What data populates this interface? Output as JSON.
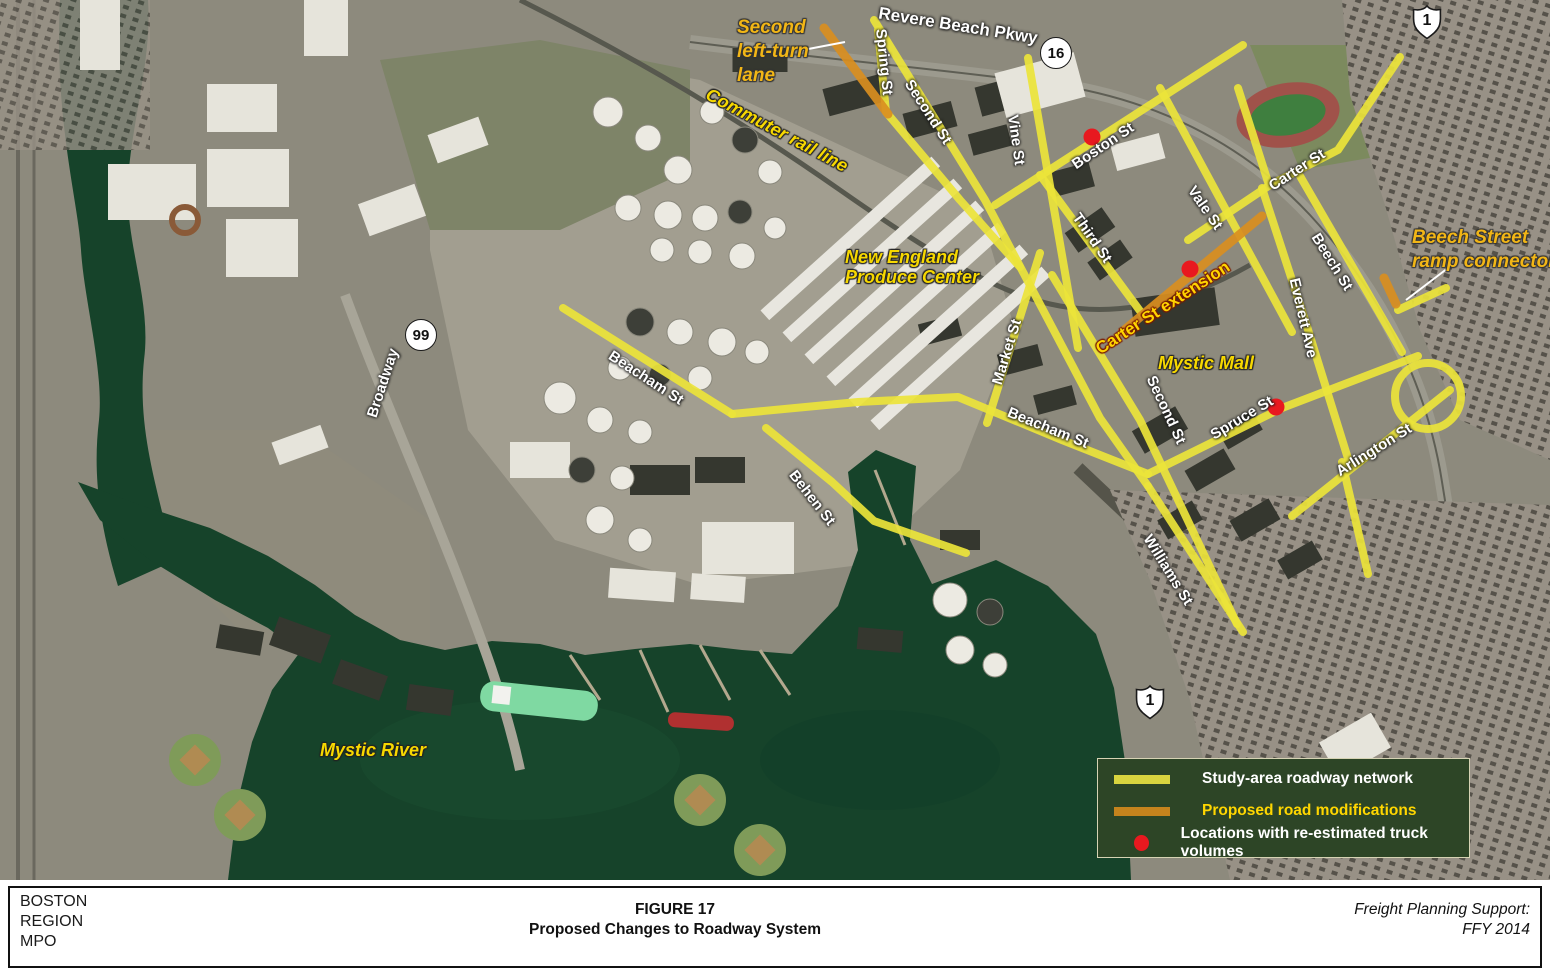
{
  "title_block": {
    "org": [
      "BOSTON",
      "REGION",
      "MPO"
    ],
    "figure_label": "FIGURE 17",
    "figure_title": "Proposed Changes to Roadway System",
    "support_line1": "Freight Planning Support:",
    "support_line2": "FFY 2014"
  },
  "legend": {
    "items": [
      {
        "swatch": "line",
        "color": "#d9d43f",
        "label": "Study-area roadway network",
        "label_color": "#ffffff"
      },
      {
        "swatch": "line",
        "color": "#c5831d",
        "label": "Proposed road modifications",
        "label_color": "#ffd600"
      },
      {
        "swatch": "dot",
        "color": "#e8191f",
        "label": "Locations with re-estimated truck volumes",
        "label_color": "#ffffff"
      }
    ]
  },
  "colors": {
    "study_road": "#ece43a",
    "proposed_road": "#d98e1f",
    "truck_dot": "#e8191f",
    "water": "#16432a"
  },
  "map": {
    "street_labels": [
      {
        "text": "Revere Beach Pkwy",
        "x": 958,
        "y": 26,
        "rot": 9,
        "big": true
      },
      {
        "text": "Spring St",
        "x": 884,
        "y": 62,
        "rot": 84
      },
      {
        "text": "Second St",
        "x": 928,
        "y": 112,
        "rot": 57
      },
      {
        "text": "Vine St",
        "x": 1016,
        "y": 140,
        "rot": 82
      },
      {
        "text": "Boston St",
        "x": 1103,
        "y": 146,
        "rot": -34
      },
      {
        "text": "Third St",
        "x": 1092,
        "y": 238,
        "rot": 55
      },
      {
        "text": "Vale St",
        "x": 1205,
        "y": 208,
        "rot": 55
      },
      {
        "text": "Carter St",
        "x": 1297,
        "y": 170,
        "rot": -33
      },
      {
        "text": "Beech St",
        "x": 1332,
        "y": 262,
        "rot": 58
      },
      {
        "text": "Everett Ave",
        "x": 1303,
        "y": 318,
        "rot": 77
      },
      {
        "text": "Market St",
        "x": 1007,
        "y": 352,
        "rot": -73
      },
      {
        "text": "Beacham St",
        "x": 646,
        "y": 378,
        "rot": 33
      },
      {
        "text": "Beacham St",
        "x": 1048,
        "y": 428,
        "rot": 22
      },
      {
        "text": "Behen St",
        "x": 812,
        "y": 498,
        "rot": 52
      },
      {
        "text": "Broadway",
        "x": 383,
        "y": 383,
        "rot": -72
      },
      {
        "text": "Second St",
        "x": 1166,
        "y": 410,
        "rot": 65
      },
      {
        "text": "Spruce St",
        "x": 1242,
        "y": 418,
        "rot": -31
      },
      {
        "text": "Arlington St",
        "x": 1374,
        "y": 450,
        "rot": -32
      },
      {
        "text": "Williams St",
        "x": 1168,
        "y": 570,
        "rot": 58
      }
    ],
    "feature_labels": [
      {
        "name": "commuter-rail-line-label",
        "lines": [
          "Commuter rail line"
        ],
        "x": 777,
        "y": 130,
        "rot": 28
      },
      {
        "name": "produce-center-label",
        "lines": [
          "New England",
          "Produce Center"
        ],
        "x": 912,
        "y": 267,
        "rot": 0
      },
      {
        "name": "mystic-mall-label",
        "lines": [
          "Mystic Mall"
        ],
        "x": 1206,
        "y": 363,
        "rot": 0
      },
      {
        "name": "mystic-river-label",
        "lines": [
          "Mystic River"
        ],
        "x": 373,
        "y": 750,
        "rot": 0
      },
      {
        "name": "carter-st-extension-label",
        "lines": [
          "Carter St extension"
        ],
        "x": 1163,
        "y": 308,
        "rot": -33,
        "style": "ext"
      }
    ],
    "callouts": [
      {
        "name": "second-left-turn-lane-callout",
        "lines": [
          "Second",
          "left-turn",
          "lane"
        ],
        "x": 737,
        "y": 52,
        "leader": [
          803,
          50,
          845,
          42
        ]
      },
      {
        "name": "beech-street-ramp-connector-callout",
        "lines": [
          "Beech Street",
          "ramp connector"
        ],
        "x": 1412,
        "y": 250,
        "leader": [
          1448,
          268,
          1406,
          300
        ]
      }
    ],
    "shields": [
      {
        "type": "us",
        "text": "1",
        "x": 1427,
        "y": 22
      },
      {
        "type": "us",
        "text": "1",
        "x": 1150,
        "y": 702
      },
      {
        "type": "circle",
        "text": "16",
        "x": 1055,
        "y": 52
      },
      {
        "type": "circle",
        "text": "99",
        "x": 420,
        "y": 334
      }
    ],
    "roads": [
      {
        "name": "spring-st",
        "type": "study",
        "pts": [
          [
            878,
            30
          ],
          [
            886,
            112
          ],
          [
            960,
            200
          ],
          [
            1020,
            267
          ]
        ]
      },
      {
        "name": "second-st-corridor",
        "type": "study",
        "pts": [
          [
            874,
            20
          ],
          [
            985,
            200
          ],
          [
            1100,
            418
          ],
          [
            1148,
            486
          ]
        ]
      },
      {
        "name": "williams-st",
        "type": "study",
        "pts": [
          [
            1148,
            486
          ],
          [
            1243,
            632
          ]
        ]
      },
      {
        "name": "vine-st",
        "type": "study",
        "pts": [
          [
            1028,
            58
          ],
          [
            1078,
            348
          ]
        ]
      },
      {
        "name": "boston-st",
        "type": "study",
        "pts": [
          [
            995,
            205
          ],
          [
            1243,
            45
          ]
        ]
      },
      {
        "name": "third-st",
        "type": "study",
        "pts": [
          [
            1040,
            175
          ],
          [
            1143,
            315
          ]
        ]
      },
      {
        "name": "vale-st",
        "type": "study",
        "pts": [
          [
            1160,
            88
          ],
          [
            1233,
            223
          ],
          [
            1292,
            332
          ]
        ]
      },
      {
        "name": "carter-st",
        "type": "study",
        "pts": [
          [
            1188,
            240
          ],
          [
            1270,
            185
          ],
          [
            1338,
            150
          ],
          [
            1400,
            57
          ]
        ]
      },
      {
        "name": "carter-st-north-stub",
        "type": "study",
        "pts": [
          [
            1238,
            88
          ],
          [
            1268,
            182
          ]
        ]
      },
      {
        "name": "beech-st",
        "type": "study",
        "pts": [
          [
            1300,
            176
          ],
          [
            1402,
            352
          ]
        ]
      },
      {
        "name": "everett-ave",
        "type": "study",
        "pts": [
          [
            1262,
            188
          ],
          [
            1305,
            320
          ],
          [
            1350,
            465
          ]
        ]
      },
      {
        "name": "market-st",
        "type": "study",
        "pts": [
          [
            1040,
            253
          ],
          [
            987,
            423
          ]
        ]
      },
      {
        "name": "beacham-st-west",
        "type": "study",
        "pts": [
          [
            563,
            308
          ],
          [
            732,
            414
          ]
        ]
      },
      {
        "name": "beacham-st-mid",
        "type": "study",
        "pts": [
          [
            732,
            414
          ],
          [
            858,
            402
          ],
          [
            958,
            397
          ],
          [
            1062,
            440
          ],
          [
            1148,
            474
          ]
        ]
      },
      {
        "name": "behen-st",
        "type": "study",
        "pts": [
          [
            766,
            428
          ],
          [
            832,
            482
          ],
          [
            874,
            521
          ],
          [
            966,
            553
          ]
        ]
      },
      {
        "name": "second-st-south",
        "type": "study",
        "pts": [
          [
            1052,
            275
          ],
          [
            1140,
            420
          ],
          [
            1237,
            624
          ]
        ]
      },
      {
        "name": "spruce-st",
        "type": "study",
        "pts": [
          [
            1148,
            474
          ],
          [
            1282,
            408
          ],
          [
            1418,
            356
          ]
        ]
      },
      {
        "name": "arlington-st",
        "type": "study",
        "pts": [
          [
            1292,
            516
          ],
          [
            1450,
            390
          ]
        ]
      },
      {
        "name": "southeast-connector",
        "type": "study",
        "pts": [
          [
            1342,
            462
          ],
          [
            1368,
            574
          ]
        ]
      },
      {
        "name": "ramp-junction",
        "type": "study",
        "pts": [
          [
            1398,
            310
          ],
          [
            1446,
            288
          ]
        ]
      },
      {
        "name": "loop-ramp",
        "type": "study",
        "circle": [
          1428,
          396,
          33
        ]
      },
      {
        "name": "second-left-turn-lane",
        "type": "proposed",
        "pts": [
          [
            824,
            28
          ],
          [
            888,
            114
          ]
        ]
      },
      {
        "name": "carter-st-extension",
        "type": "proposed",
        "pts": [
          [
            1122,
            332
          ],
          [
            1262,
            216
          ]
        ]
      },
      {
        "name": "beech-street-ramp-connector",
        "type": "proposed",
        "pts": [
          [
            1384,
            278
          ],
          [
            1396,
            304
          ]
        ]
      }
    ],
    "truck_volume_dots": [
      {
        "name": "boston-st-location",
        "x": 1092,
        "y": 137
      },
      {
        "name": "carter-ext-location",
        "x": 1190,
        "y": 269
      },
      {
        "name": "spruce-st-location",
        "x": 1276,
        "y": 407
      }
    ]
  }
}
